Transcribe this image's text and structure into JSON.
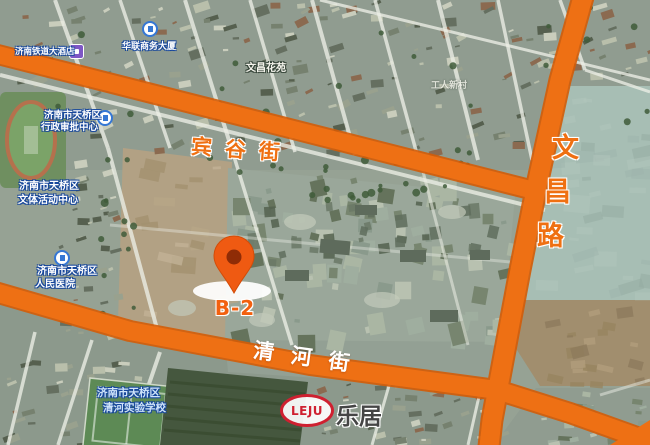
{
  "map": {
    "road_labels": {
      "bingu": "宾谷街",
      "qinghe": "清河街",
      "wenchang": [
        "文",
        "昌",
        "路"
      ]
    },
    "marker": {
      "label": "B-2"
    },
    "pois": [
      {
        "name": "hotel",
        "text": "济南铁道大酒店"
      },
      {
        "name": "office",
        "text": "华联商务大厦"
      },
      {
        "name": "admin-center",
        "line1": "济南市天桥区",
        "line2": "行政审批中心"
      },
      {
        "name": "sports-center",
        "line1": "济南市天桥区",
        "line2": "文体活动中心"
      },
      {
        "name": "hospital",
        "line1": "济南市天桥区",
        "line2": "人民医院"
      },
      {
        "name": "school",
        "line1": "济南市天桥区",
        "line2": "清河实验学校"
      }
    ],
    "minor_labels": [
      {
        "text": "文昌花苑"
      },
      {
        "text": "工人新村"
      }
    ],
    "logo": {
      "latin": "LEJU",
      "cn": "乐居"
    },
    "colors": {
      "road_orange": "#ee7014",
      "road_casing": "#d45c07",
      "road_label_orange": "#ef7012",
      "marker_orange": "#ef5a12",
      "logo_red": "#cf2030",
      "poi_halo_blue": "#17479c",
      "dirt": "#b2a184",
      "teal_field": "#a7beb4"
    }
  }
}
